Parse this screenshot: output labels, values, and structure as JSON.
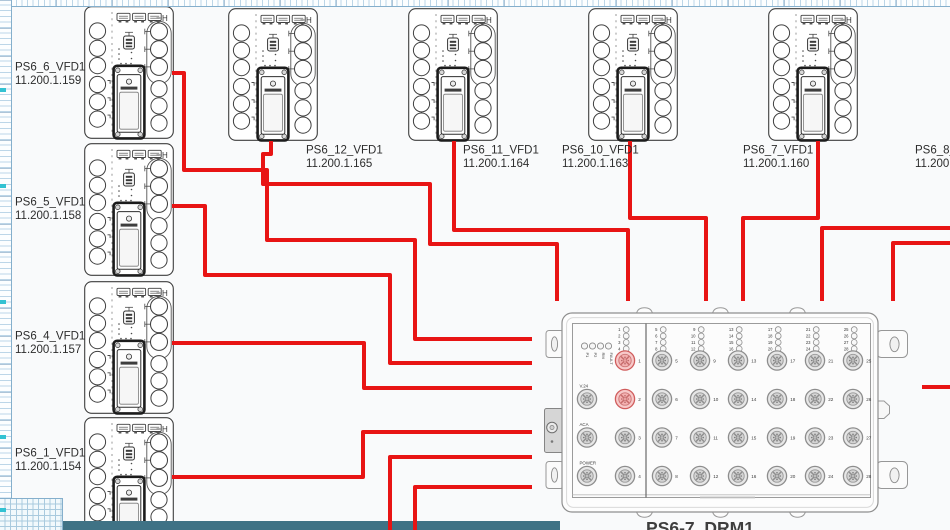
{
  "page": {
    "background": "#f9fafb",
    "bottom_band_color": "#3f7285",
    "ruler_mark_color": "#33c2d2"
  },
  "rulers": {
    "left_marks": [
      88,
      184,
      300,
      435,
      508
    ]
  },
  "devices": {
    "rail_marker": "H",
    "left": [
      {
        "name": "PS6_6_VFD1",
        "ip": "11.200.1.159",
        "x": 84,
        "y": 6,
        "label_x": 15,
        "label_y": 61
      },
      {
        "name": "PS6_5_VFD1",
        "ip": "11.200.1.158",
        "x": 84,
        "y": 143,
        "label_x": 15,
        "label_y": 196
      },
      {
        "name": "PS6_4_VFD1",
        "ip": "11.200.1.157",
        "x": 84,
        "y": 281,
        "label_x": 15,
        "label_y": 330
      },
      {
        "name": "PS6_1_VFD1",
        "ip": "11.200.1.154",
        "x": 84,
        "y": 417,
        "label_x": 15,
        "label_y": 447
      }
    ],
    "top": [
      {
        "name": "PS6_12_VFD1",
        "ip": "11.200.1.165",
        "x": 228,
        "y": 8,
        "label_x": 306,
        "label_y": 144
      },
      {
        "name": "PS6_11_VFD1",
        "ip": "11.200.1.164",
        "x": 408,
        "y": 8,
        "label_x": 463,
        "label_y": 144
      },
      {
        "name": "PS6_10_VFD1",
        "ip": "11.200.1.163",
        "x": 588,
        "y": 8,
        "label_x": 562,
        "label_y": 144
      },
      {
        "name": "PS6_7_VFD1",
        "ip": "11.200.1.160",
        "x": 768,
        "y": 8,
        "label_x": 743,
        "label_y": 144
      }
    ],
    "partial_right": {
      "name": "PS6_8_V",
      "ip": "11.200.1",
      "label_x": 915,
      "label_y": 144
    }
  },
  "switch": {
    "name": "PS6-7_DRM1",
    "indicator_leds": [
      "P1",
      "P2",
      "RM",
      "FAULT"
    ],
    "aux_ports": [
      {
        "label": "V.24"
      },
      {
        "label": "ACA"
      },
      {
        "label": "POWER"
      }
    ],
    "port_columns": [
      {
        "leds": [
          "1",
          "2",
          "3",
          "4"
        ],
        "ports": [
          {
            "n": "1",
            "red": true
          },
          {
            "n": "2",
            "red": true
          },
          {
            "n": "3",
            "red": false
          },
          {
            "n": "4",
            "red": false
          }
        ]
      },
      {
        "leds": [
          "5",
          "6",
          "7",
          "8"
        ],
        "ports": [
          {
            "n": "5",
            "red": false
          },
          {
            "n": "6",
            "red": false
          },
          {
            "n": "7",
            "red": false
          },
          {
            "n": "8",
            "red": false
          }
        ]
      },
      {
        "leds": [
          "9",
          "10",
          "11",
          "12"
        ],
        "ports": [
          {
            "n": "9",
            "red": false
          },
          {
            "n": "10",
            "red": false
          },
          {
            "n": "11",
            "red": false
          },
          {
            "n": "12",
            "red": false
          }
        ]
      },
      {
        "leds": [
          "13",
          "14",
          "15",
          "16"
        ],
        "ports": [
          {
            "n": "13",
            "red": false
          },
          {
            "n": "14",
            "red": false
          },
          {
            "n": "15",
            "red": false
          },
          {
            "n": "16",
            "red": false
          }
        ]
      },
      {
        "leds": [
          "17",
          "18",
          "19",
          "20"
        ],
        "ports": [
          {
            "n": "17",
            "red": false
          },
          {
            "n": "18",
            "red": false
          },
          {
            "n": "19",
            "red": false
          },
          {
            "n": "20",
            "red": false
          }
        ]
      },
      {
        "leds": [
          "21",
          "22",
          "23",
          "24"
        ],
        "ports": [
          {
            "n": "21",
            "red": false
          },
          {
            "n": "22",
            "red": false
          },
          {
            "n": "23",
            "red": false
          },
          {
            "n": "24",
            "red": false
          }
        ]
      },
      {
        "leds": [
          "25",
          "26",
          "27",
          "28"
        ],
        "ports": [
          {
            "n": "25",
            "red": false
          },
          {
            "n": "26",
            "red": false
          },
          {
            "n": "27",
            "red": false
          },
          {
            "n": "28",
            "red": false
          }
        ]
      }
    ]
  },
  "cables": {
    "color": "#e81414",
    "width": 4,
    "routes": [
      {
        "id": "ps6-6-vfd1",
        "points": [
          [
            172,
            73
          ],
          [
            184,
            73
          ],
          [
            184,
            170
          ],
          [
            267,
            170
          ],
          [
            267,
            240
          ],
          [
            415,
            240
          ],
          [
            415,
            339
          ],
          [
            532,
            339
          ]
        ]
      },
      {
        "id": "ps6-5-vfd1",
        "points": [
          [
            172,
            206
          ],
          [
            205,
            206
          ],
          [
            205,
            275
          ],
          [
            390,
            275
          ],
          [
            390,
            363
          ],
          [
            532,
            363
          ]
        ]
      },
      {
        "id": "ps6-4-vfd1",
        "points": [
          [
            172,
            343
          ],
          [
            364,
            343
          ],
          [
            364,
            388
          ],
          [
            532,
            388
          ]
        ]
      },
      {
        "id": "ps6-1-vfd1",
        "points": [
          [
            172,
            477
          ],
          [
            363,
            477
          ],
          [
            363,
            432
          ],
          [
            532,
            432
          ]
        ]
      },
      {
        "id": "ps6-12-vfd1",
        "points": [
          [
            271,
            141
          ],
          [
            271,
            154
          ],
          [
            263,
            154
          ],
          [
            263,
            184
          ],
          [
            430,
            184
          ],
          [
            430,
            244
          ],
          [
            557,
            244
          ],
          [
            557,
            301
          ]
        ]
      },
      {
        "id": "ps6-11-vfd1",
        "points": [
          [
            454,
            141
          ],
          [
            454,
            230
          ],
          [
            628,
            230
          ],
          [
            628,
            301
          ]
        ]
      },
      {
        "id": "ps6-10-vfd1",
        "points": [
          [
            630,
            141
          ],
          [
            630,
            218
          ],
          [
            706,
            218
          ],
          [
            706,
            301
          ]
        ]
      },
      {
        "id": "ps6-7-vfd1",
        "points": [
          [
            818,
            141
          ],
          [
            818,
            218
          ],
          [
            743,
            218
          ],
          [
            743,
            301
          ]
        ]
      },
      {
        "id": "right-edge-a",
        "points": [
          [
            950,
            228
          ],
          [
            822,
            228
          ],
          [
            822,
            301
          ]
        ]
      },
      {
        "id": "right-edge-b",
        "points": [
          [
            950,
            243
          ],
          [
            893,
            243
          ],
          [
            893,
            301
          ]
        ]
      },
      {
        "id": "right-edge-c",
        "points": [
          [
            950,
            387
          ],
          [
            922,
            387
          ]
        ]
      },
      {
        "id": "bottom-edge-a",
        "points": [
          [
            390,
            531
          ],
          [
            390,
            457
          ],
          [
            532,
            457
          ]
        ]
      },
      {
        "id": "bottom-edge-b",
        "points": [
          [
            415,
            531
          ],
          [
            415,
            487
          ],
          [
            532,
            487
          ]
        ]
      }
    ]
  }
}
